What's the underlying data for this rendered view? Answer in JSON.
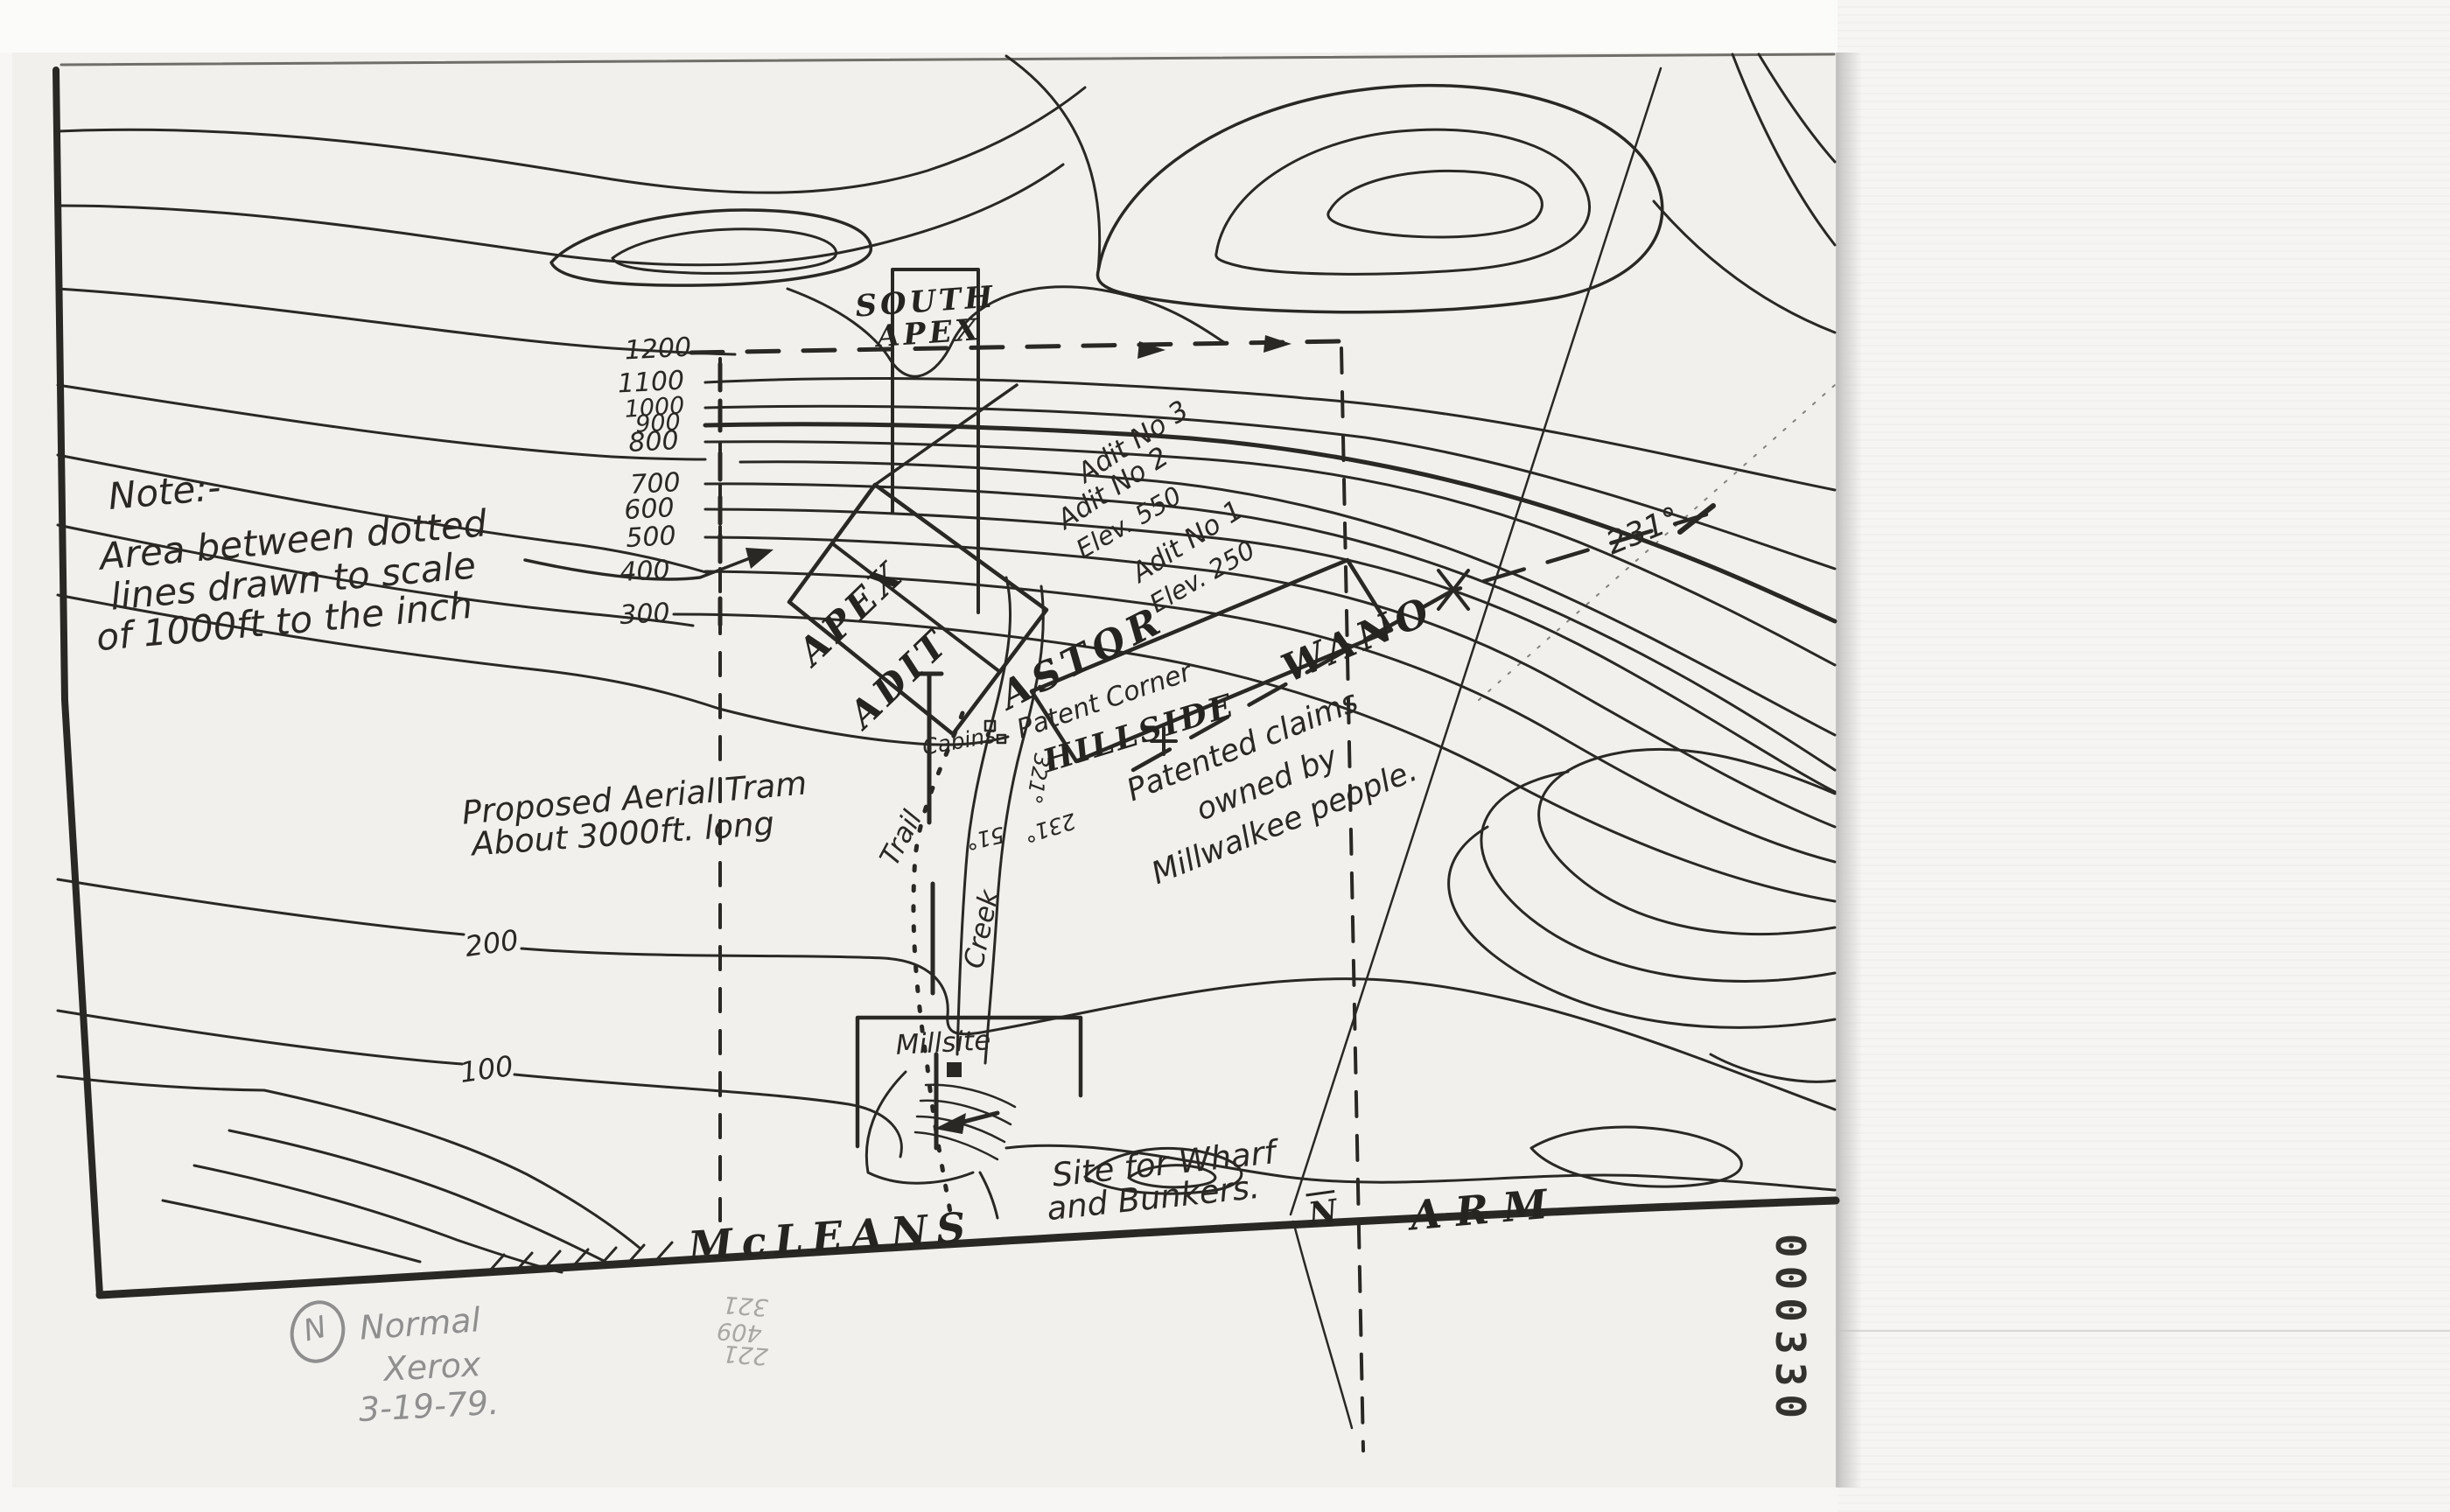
{
  "document": {
    "kind": "Scanned hand-drawn topographic mining-claim map",
    "copy_note": "Normal Xerox 3-19-79",
    "stamp_number": "000330"
  },
  "note": {
    "line1": "Note:-",
    "line2": "Area between dotted",
    "line3": "lines drawn to scale",
    "line4": "of 1000ft to the inch"
  },
  "elevations": {
    "e1200": "1200",
    "e1100": "1100",
    "e1000": "1000",
    "e900": "900",
    "e800": "800",
    "e700": "700",
    "e600": "600",
    "e500": "500",
    "e400": "400",
    "e300": "300",
    "e200": "200",
    "e100": "100"
  },
  "adits": {
    "adit3": "Adit No 3",
    "adit2": "Adit No 2",
    "adit2_elev": "Elev. 550",
    "adit1": "Adit No 1",
    "adit1_elev": "Elev. 250"
  },
  "claims": {
    "south_apex_line1": "SOUTH",
    "south_apex_line2": "APEX",
    "apex": "APEX",
    "adit": "ADIT",
    "astor": "ASTOR",
    "hillside": "HILLSIDE",
    "wano": "WANO",
    "patent_corner": "Patent Corner",
    "millsite": "Millsite",
    "patented_line1": "Patented claims",
    "patented_line2": "owned by",
    "patented_line3": "Millwalkee people."
  },
  "features": {
    "cabins": "Cabins",
    "trail": "Trail",
    "creek": "Creek",
    "tram_line1": "Proposed Aerial Tram",
    "tram_line2": "About 3000ft. long",
    "wharf_line1": "Site for Wharf",
    "wharf_line2": "and Bunkers.",
    "water_name_1": "McLEANS",
    "water_name_2": "ARM",
    "north_mark": "N"
  },
  "bearings": {
    "b231": "231°",
    "b231_small": "231°",
    "b51": "51°",
    "b321": "321°"
  },
  "pencil_notes": {
    "circled_n": "N",
    "line1": "Normal",
    "line2": "Xerox",
    "line3": "3-19-79.",
    "fig1": "321",
    "fig2": "409",
    "fig3": "221"
  },
  "stamp": {
    "number": "000330"
  },
  "colors": {
    "ink": "#2a2824",
    "pencil": "#908f90",
    "paper": "#f1f0ec",
    "margin": "#f6f5f3"
  }
}
